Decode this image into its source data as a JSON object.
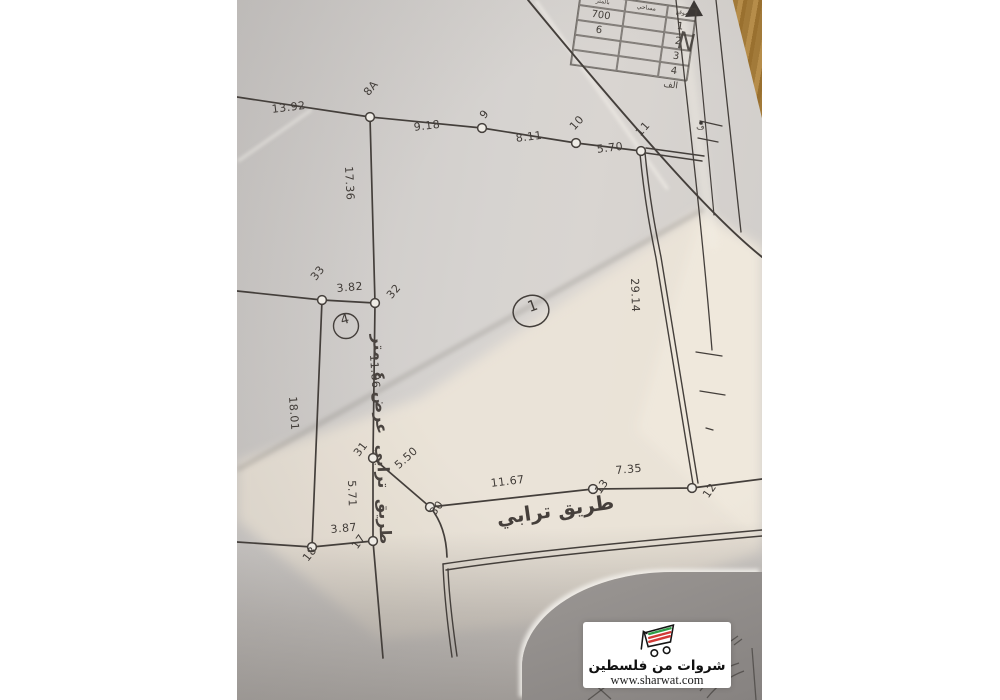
{
  "map": {
    "road_label": "طريق ترابي",
    "strip_road_label": "طريق ترابي عرض ٤ متر",
    "parcel_circle_label": "1",
    "strip_circle_label": "4",
    "north_label": "N",
    "nbox_glyph": "ف",
    "measurements": {
      "m13_92": "13.92",
      "m9_18": "9.18",
      "m8_11": "8.11",
      "m5_70": "5.70",
      "m17_36": "17.36",
      "m3_82": "3.82",
      "m11_86": "11.86",
      "m18_01": "18.01",
      "m5_50": "5.50",
      "m5_71": "5.71",
      "m3_87": "3.87",
      "m11_67": "11.67",
      "m7_35": "7.35",
      "m29_14": "29.14"
    },
    "points": {
      "p8A": "8A",
      "p9": "9",
      "p10": "10",
      "p11": "11",
      "p12": "12",
      "p13": "13",
      "p17": "17",
      "p18": "18",
      "p30": "30",
      "p31": "31",
      "p32": "32",
      "p33": "33"
    }
  },
  "legend_table": {
    "headers": [
      "بالمتر",
      "مساحي",
      "موقع"
    ],
    "rows": [
      [
        "700",
        "",
        "1"
      ],
      [
        "6",
        "",
        "2"
      ],
      [
        "",
        "",
        "3"
      ],
      [
        "",
        "",
        "4"
      ]
    ],
    "footer": "الف"
  },
  "watermark": {
    "brand": "شروات من فلسطين",
    "url": "www.sharwat.com"
  },
  "colors": {
    "ink": "#443f3b",
    "logo_green": "#2f9e47",
    "logo_red": "#d23a36",
    "wood": "#a87f3e"
  }
}
